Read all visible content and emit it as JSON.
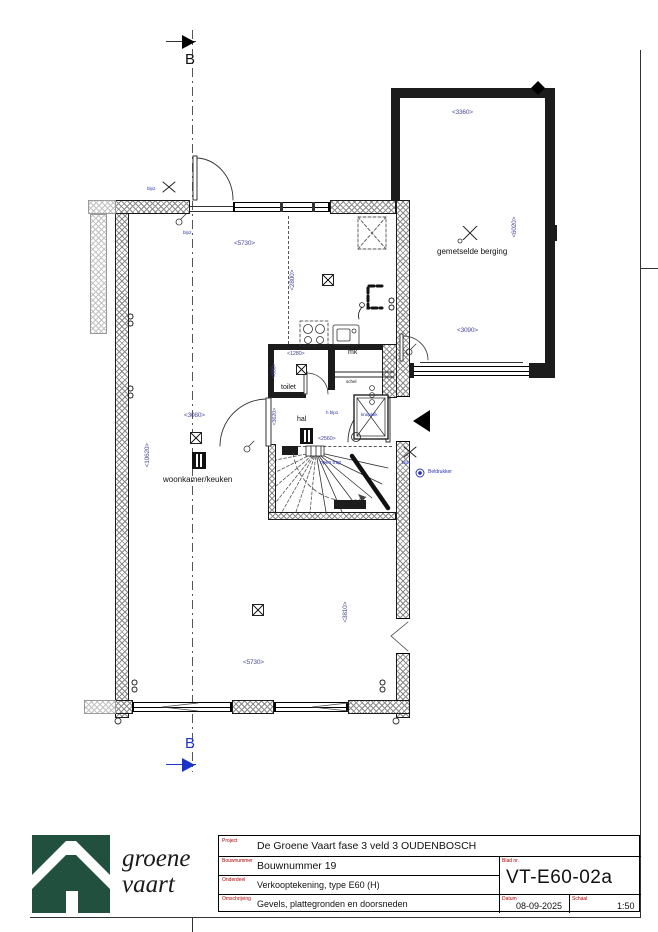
{
  "colors": {
    "logo_green": "#21503f",
    "annotation_blue": "#2733b8",
    "dimension_blue": "#4a4a9c",
    "label_red": "#b30000"
  },
  "sheet": {
    "section_b_top": "B",
    "section_b_bottom": "B"
  },
  "plan": {
    "rooms": {
      "living": "woonkamer/keuken",
      "toilet": "toilet",
      "hall": "hal",
      "meter_closet": "mk",
      "storage": "gemetselde berging",
      "open_stair": "open trap",
      "crawl_hatch": "kruipluik",
      "door_chime": "schel"
    },
    "annotations": {
      "outdoor_light_a": "blp2",
      "outdoor_light_b": "blp2",
      "side_light": "blp1",
      "hall_switch": "h  blp1",
      "bell_button": "Beldrukker"
    },
    "dims": [
      "<3360>",
      "<6020>",
      "<3090>",
      "<5730>",
      "<2800>",
      "<3080>",
      "<10620>",
      "<1280>",
      "<880>",
      "<3620>",
      "<2560>",
      "<5730>",
      "<3810>"
    ]
  },
  "title_block": {
    "labels": {
      "project": "Project",
      "bouwnummer": "Bouwnummer",
      "onderdeel": "Onderdeel",
      "omschrijving": "Omschrijving",
      "blad": "Blad nr.",
      "datum": "Datum",
      "schaal": "Schaal"
    },
    "project": "De Groene Vaart fase 3 veld 3 OUDENBOSCH",
    "bouwnummer": "Bouwnummer 19",
    "onderdeel": "Verkooptekening, type E60 (H)",
    "omschrijving": "Gevels, plattegronden en doorsneden",
    "blad_nr": "VT-E60-02a",
    "datum": "08-09-2025",
    "schaal": "1:50"
  },
  "logo": {
    "line1": "groene",
    "line2": "vaart"
  }
}
